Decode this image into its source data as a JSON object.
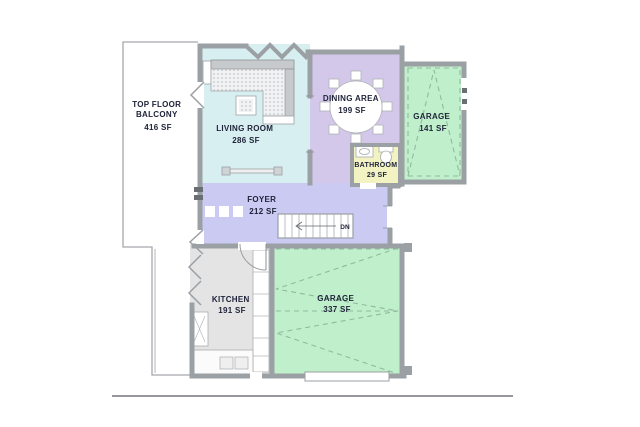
{
  "plan": {
    "title": "floor-plan",
    "rooms": {
      "balcony": {
        "name_line1": "TOP FLOOR",
        "name_line2": "BALCONY",
        "area": "416 SF"
      },
      "living_room": {
        "name": "LIVING ROOM",
        "area": "286 SF"
      },
      "dining_area": {
        "name": "DINING AREA",
        "area": "199 SF"
      },
      "garage_upper": {
        "name": "GARAGE",
        "area": "141 SF"
      },
      "bathroom": {
        "name": "BATHROOM",
        "area": "29 SF"
      },
      "foyer": {
        "name": "FOYER",
        "area": "212 SF"
      },
      "kitchen": {
        "name": "KITCHEN",
        "area": "191 SF"
      },
      "garage_lower": {
        "name": "GARAGE",
        "area": "337 SF"
      }
    },
    "stairs": {
      "direction_label": "DN"
    },
    "colors": {
      "living_room": "#d8eff1",
      "dining_area": "#d4c8ea",
      "foyer": "#cacaf2",
      "garage": "#c0efcc",
      "bathroom": "#f2f2c2",
      "kitchen": "#e4e4e4",
      "wall": "#9ba0a4",
      "wall_dark": "#6a6f73",
      "garage_door_dash": "#90bb9e",
      "label_text": "#20243a",
      "fixture_stroke": "#a8acb0",
      "sofa_back": "#c6cacd"
    }
  }
}
